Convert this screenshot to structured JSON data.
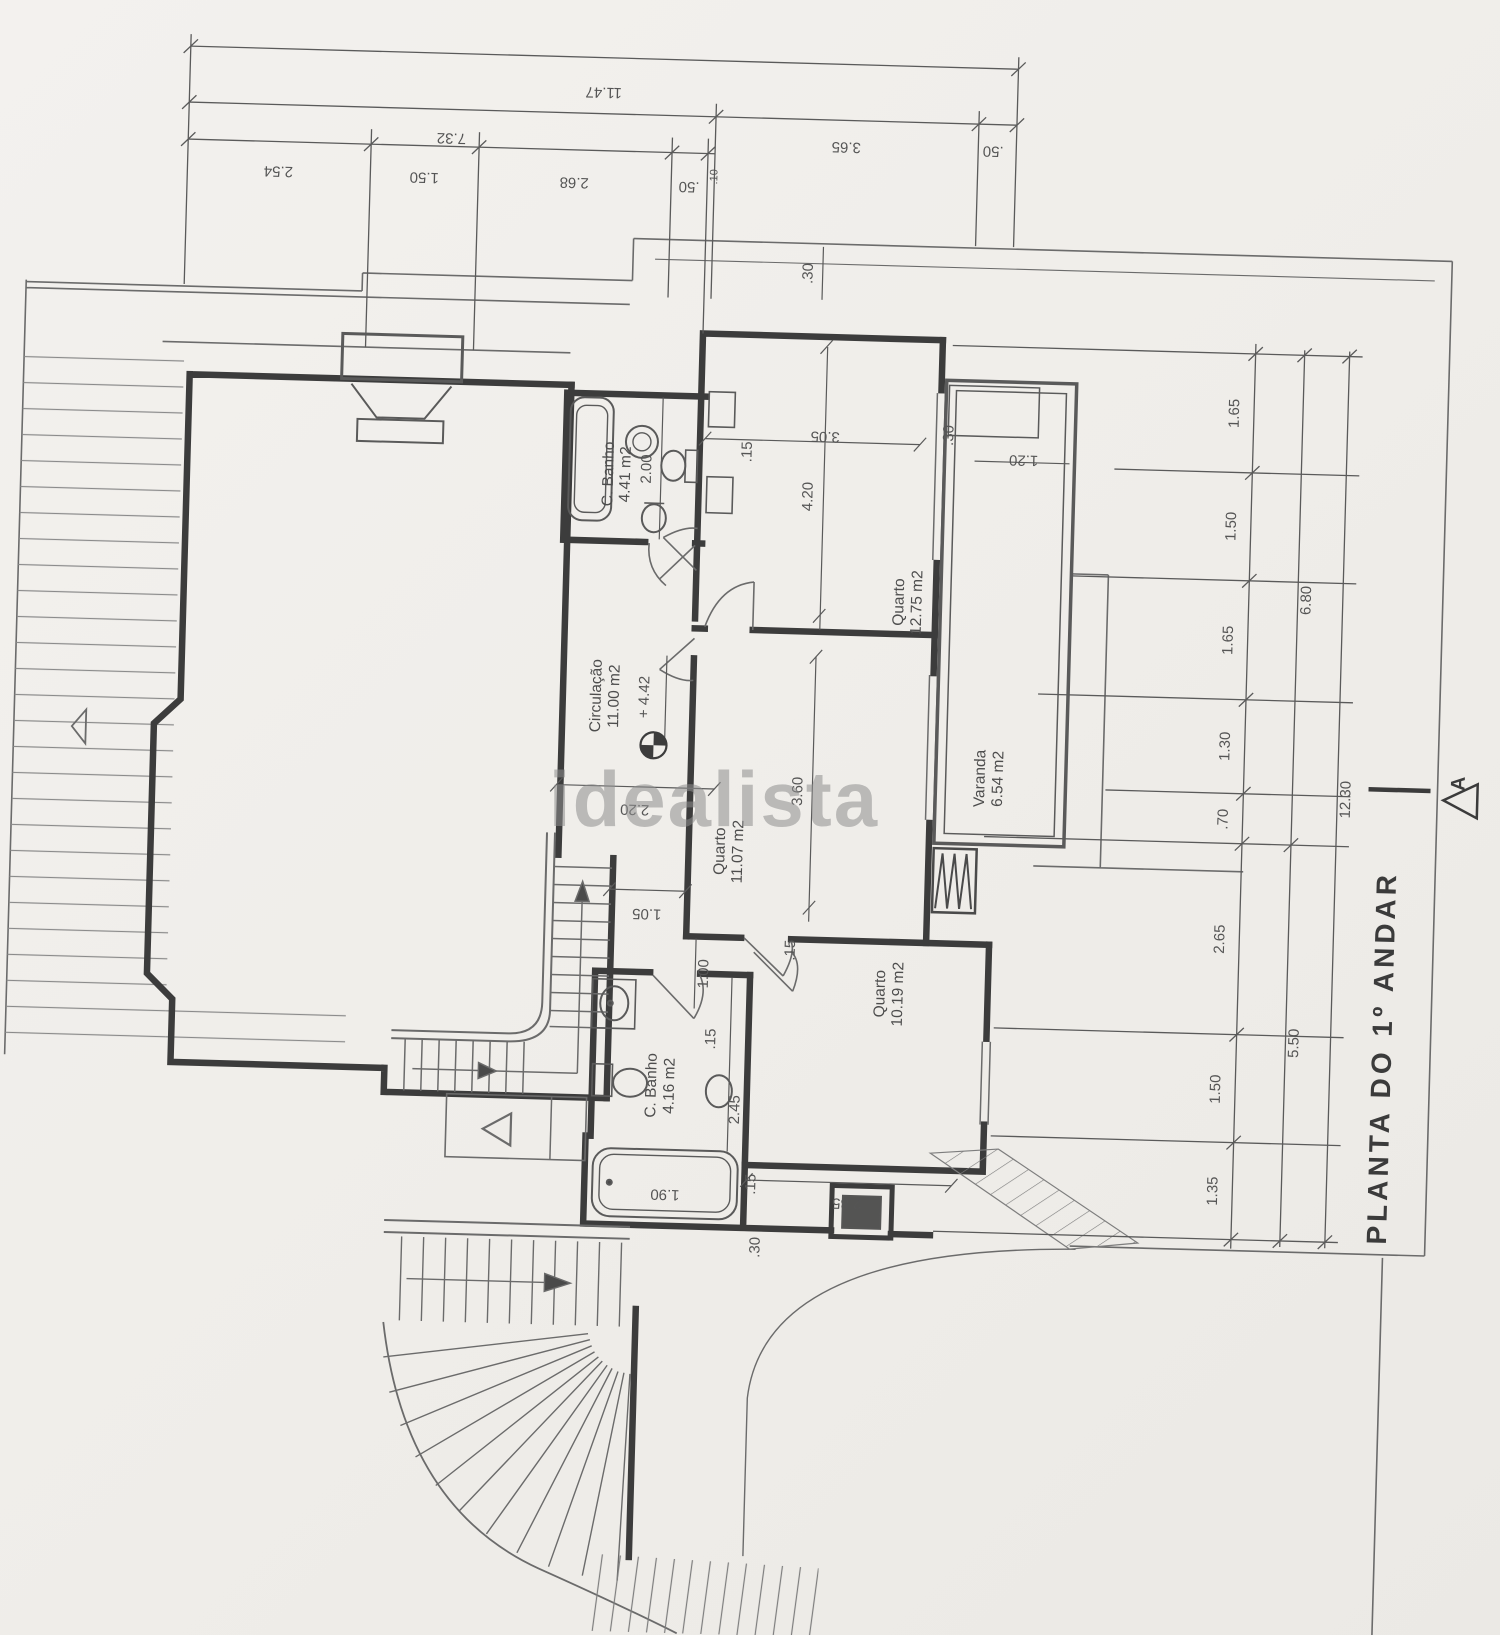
{
  "watermark": "idealista",
  "plan": {
    "title": "PLANTA DO 1º ANDAR",
    "section_label": "A",
    "level_mark": "+ 4.42"
  },
  "rooms": [
    {
      "name": "C. Banho",
      "area": "4.41 m2"
    },
    {
      "name": "Circulação",
      "area": "11.00 m2"
    },
    {
      "name": "Quarto",
      "area": "12.75 m2"
    },
    {
      "name": "Varanda",
      "area": "6.54 m2"
    },
    {
      "name": "Quarto",
      "area": "11.07 m2"
    },
    {
      "name": "Quarto",
      "area": "10.19 m2"
    },
    {
      "name": "C. Banho",
      "area": "4.16 m2"
    }
  ],
  "dims": {
    "top1": [
      "11.47"
    ],
    "top2": [
      "7.32",
      "3.65",
      ".50"
    ],
    "top3": [
      "2.54",
      "1.50",
      "2.68",
      ".50",
      ".10"
    ],
    "right_inner": [
      "1.65",
      "1.50",
      "1.65",
      "1.30",
      ".70",
      "2.65",
      "1.50",
      "1.35"
    ],
    "right_mid": [
      "6.80",
      "5.50"
    ],
    "right_outer": [
      "12.30"
    ],
    "in": [
      ".30",
      ".15",
      "2.00",
      "3.05",
      "4.20",
      ".30",
      "1.20",
      "2.20",
      "3.60",
      "1.05",
      "1.00",
      ".15",
      "2.45",
      "1.90",
      ".15",
      ".30",
      "2.85",
      ".15"
    ]
  }
}
